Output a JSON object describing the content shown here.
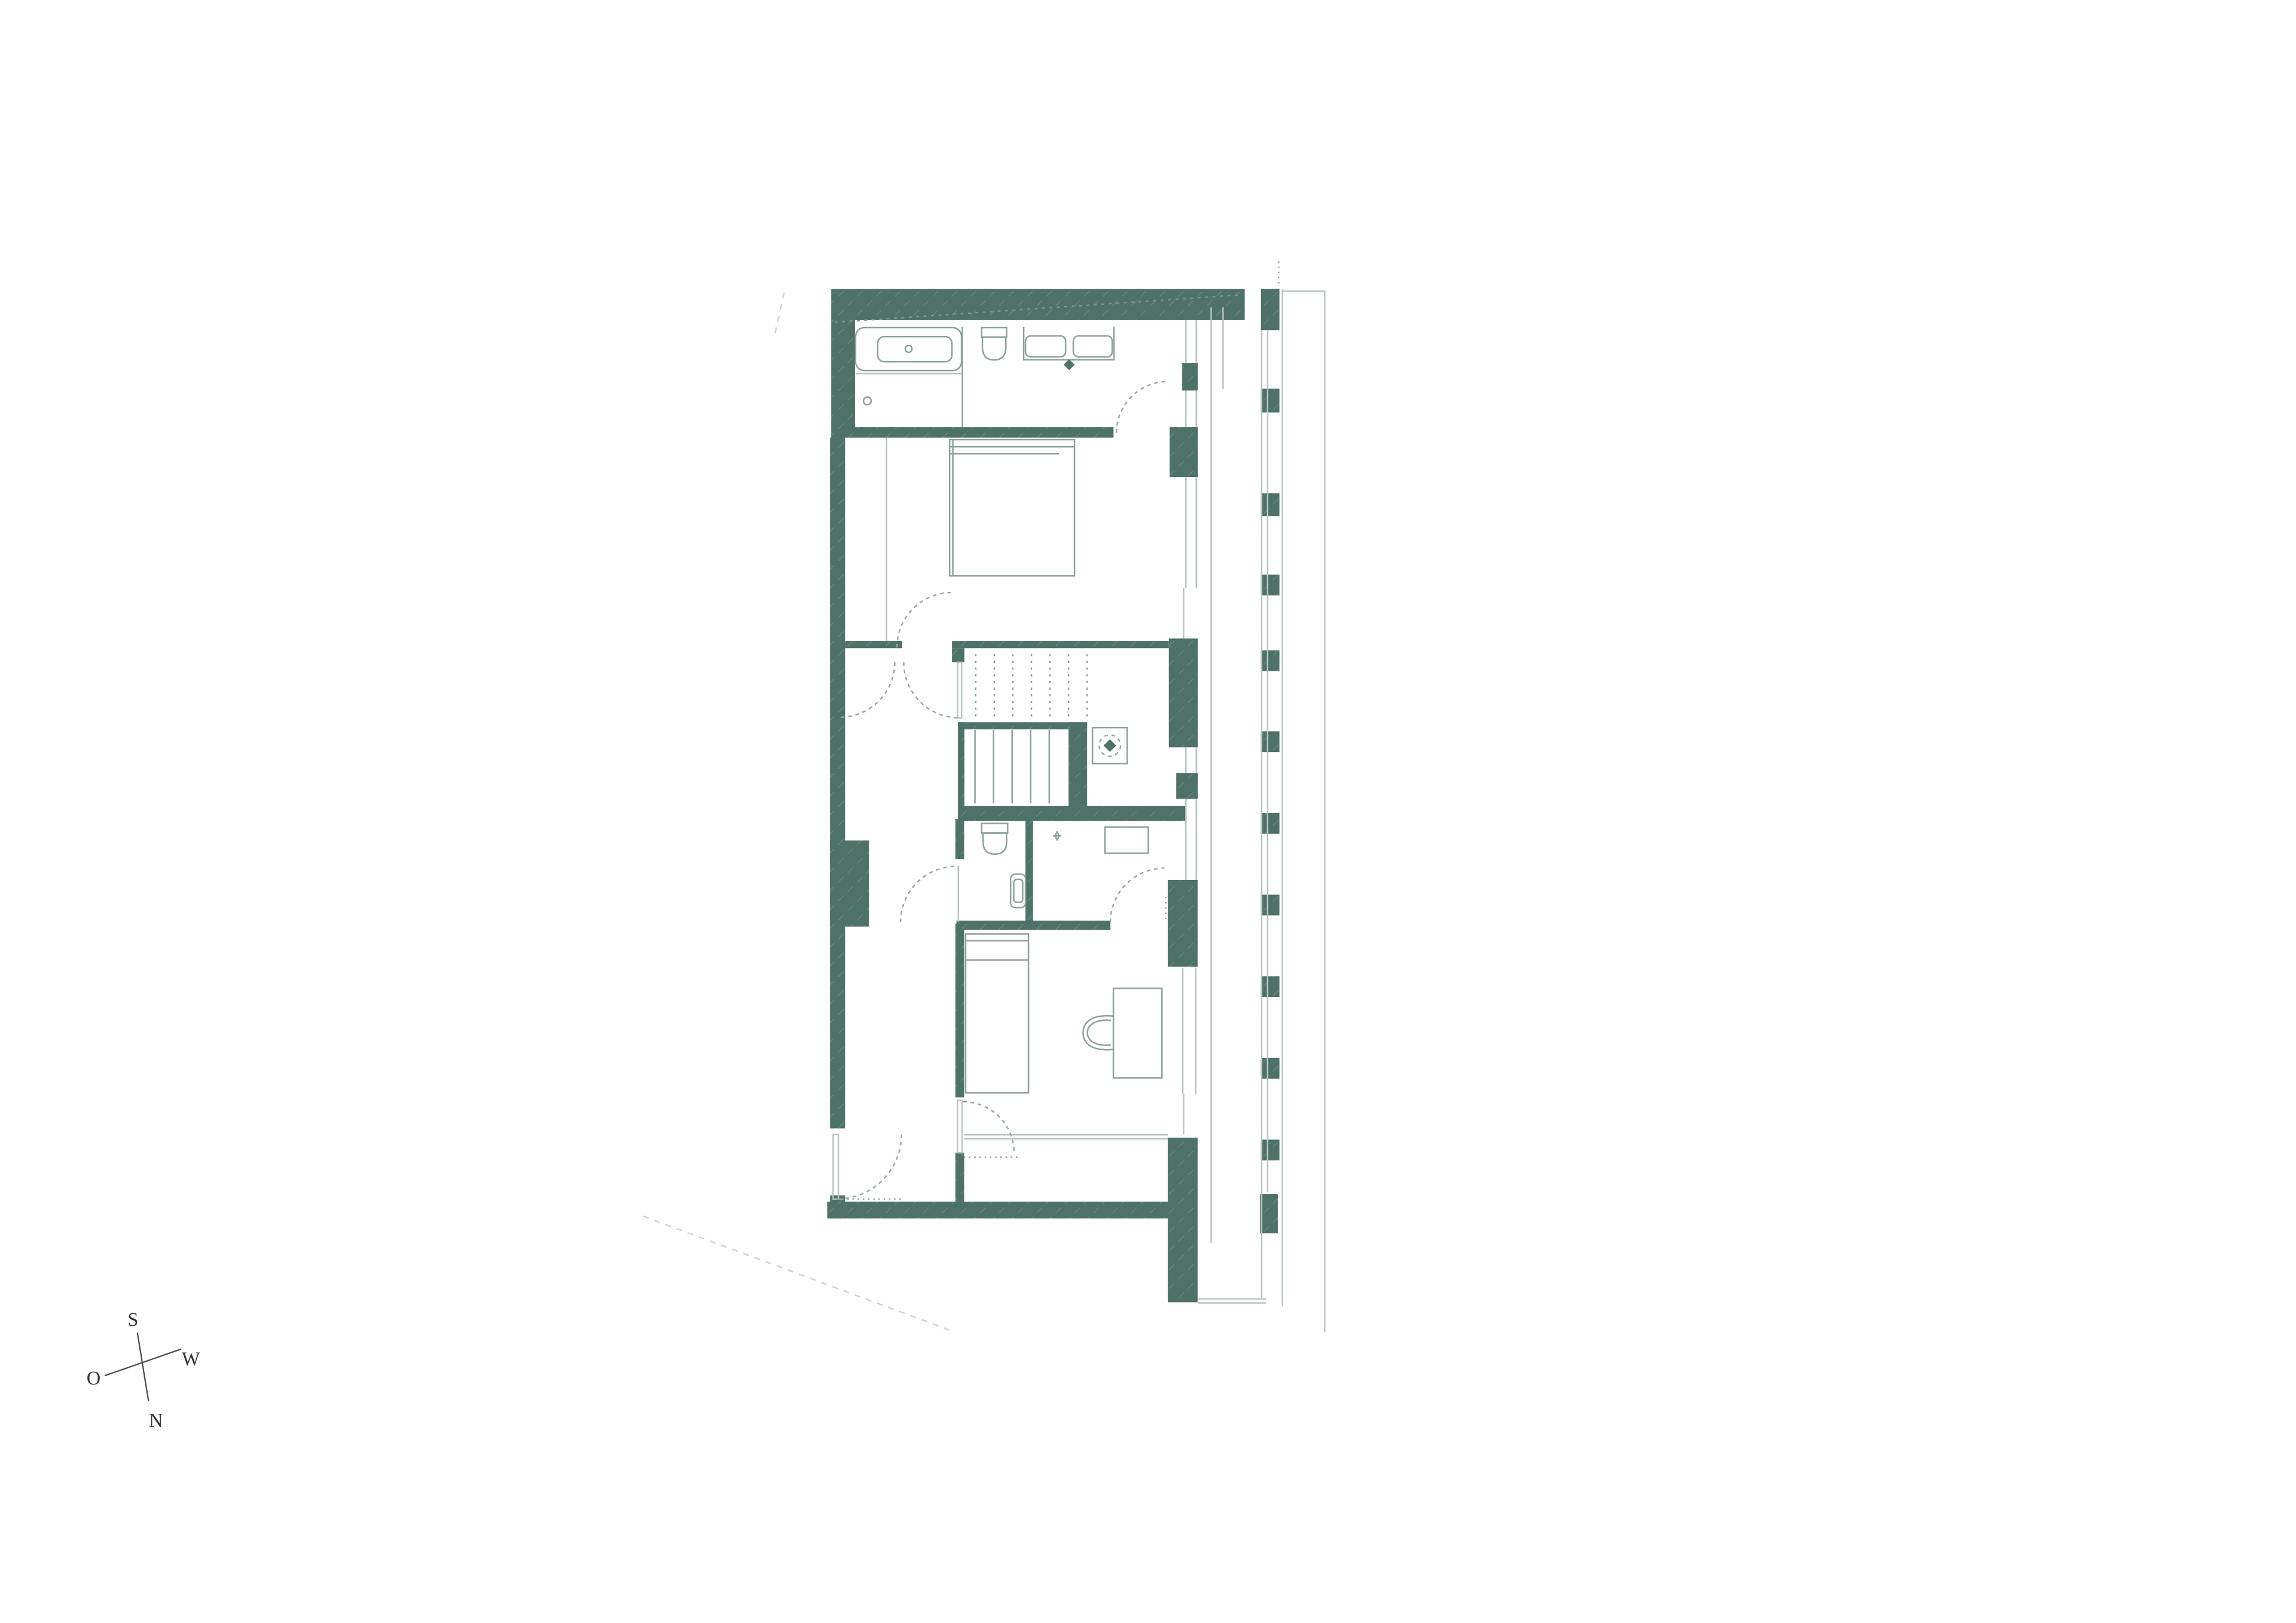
{
  "meta": {
    "type": "architectural floor plan",
    "content": "upper floor plan with bathroom, bedroom, stair core, wc, corridor, second bedroom and glazed east facade"
  },
  "compass": {
    "top": "S",
    "right": "W",
    "left": "O",
    "bottom": "N"
  },
  "colors": {
    "background": "#ffffff",
    "wall": "#4e7168",
    "wall_hatch_light": "#7b968e",
    "line_light": "#b9c4c0",
    "line_mid": "#8fa09b",
    "fixture": "#8fa09b",
    "door_arc": "#9aa9a4",
    "site_line": "#ccd4d1",
    "compass_text": "#333333",
    "compass_line": "#4a4a4a"
  },
  "stairs": {
    "upper_flight_treads": 7,
    "lower_flight_treads": 5
  },
  "rooms": [
    {
      "name": "bathroom"
    },
    {
      "name": "bedroom"
    },
    {
      "name": "stair-hall"
    },
    {
      "name": "wc"
    },
    {
      "name": "corridor"
    },
    {
      "name": "bedroom-2"
    },
    {
      "name": "facade-gallery"
    }
  ]
}
